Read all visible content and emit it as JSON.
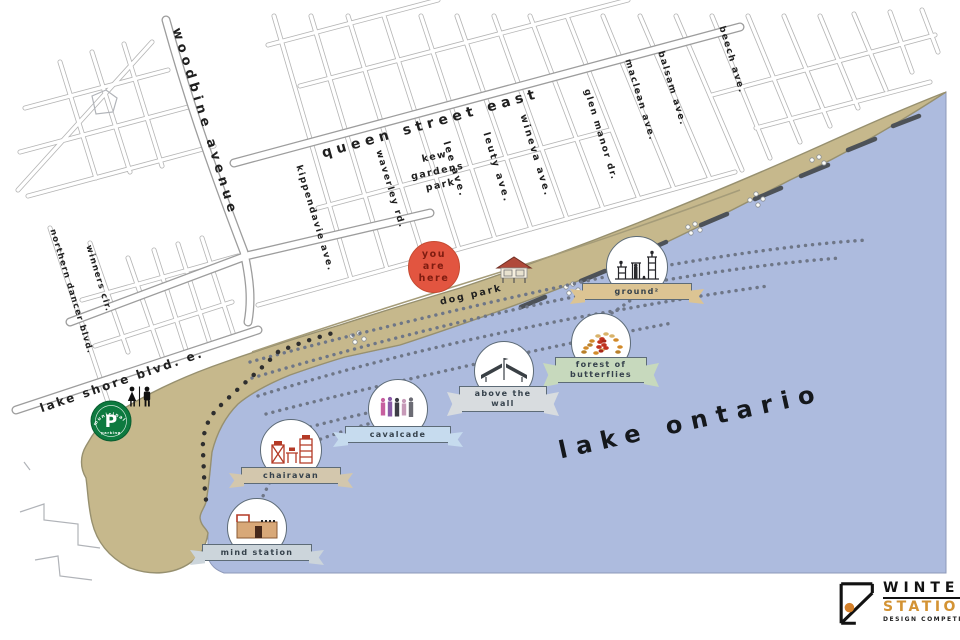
{
  "streets": {
    "woodbine": "woodbine avenue",
    "queen": "queen street east",
    "kippendavie": "kippendavie ave.",
    "waverley": "waverley rd.",
    "lee": "lee ave.",
    "leuty": "leuty ave.",
    "wineva": "wineva ave.",
    "glen_manor": "glen manor dr.",
    "maclean": "maclean ave.",
    "balsam": "balsam ave.",
    "beech": "beech ave.",
    "northern_dancer": "northern dancer blvd.",
    "winners": "winners cir.",
    "lake_shore": "lake shore blvd. e."
  },
  "places": {
    "kew_gardens": {
      "line1": "kew",
      "line2": "gardens",
      "line3": "park"
    },
    "dog_park": "dog park",
    "lake": "lake ontario"
  },
  "you_are_here": {
    "line1": "you",
    "line2": "are",
    "line3": "here",
    "fill": "#e25540"
  },
  "stations": [
    {
      "name": "ground²",
      "banner_color": "#dcc493"
    },
    {
      "name": "forest of butterflies",
      "banner_color": "#c7d9bd"
    },
    {
      "name": "above the wall",
      "banner_color": "#d8dcdf"
    },
    {
      "name": "cavalcade",
      "banner_color": "#c6dbee"
    },
    {
      "name": "chairavan",
      "banner_color": "#d3c7ad"
    },
    {
      "name": "mind station",
      "banner_color": "#ccd5db"
    }
  ],
  "amenities": {
    "parking": {
      "letter": "P",
      "ring_top": "municipal",
      "ring_bottom": "parking",
      "green": "#0d7a3f"
    },
    "washroom_icon": "male-female-washroom-icon"
  },
  "logo": {
    "line1": "WINTER",
    "line2": "STATIONS",
    "line3": "DESIGN COMPETITION",
    "accent": "#d39334"
  },
  "colors": {
    "lake": "#adbbde",
    "beach": "#c6b88c",
    "road_casing": "#a7a7a7",
    "trail_dots": "#6e7687"
  }
}
